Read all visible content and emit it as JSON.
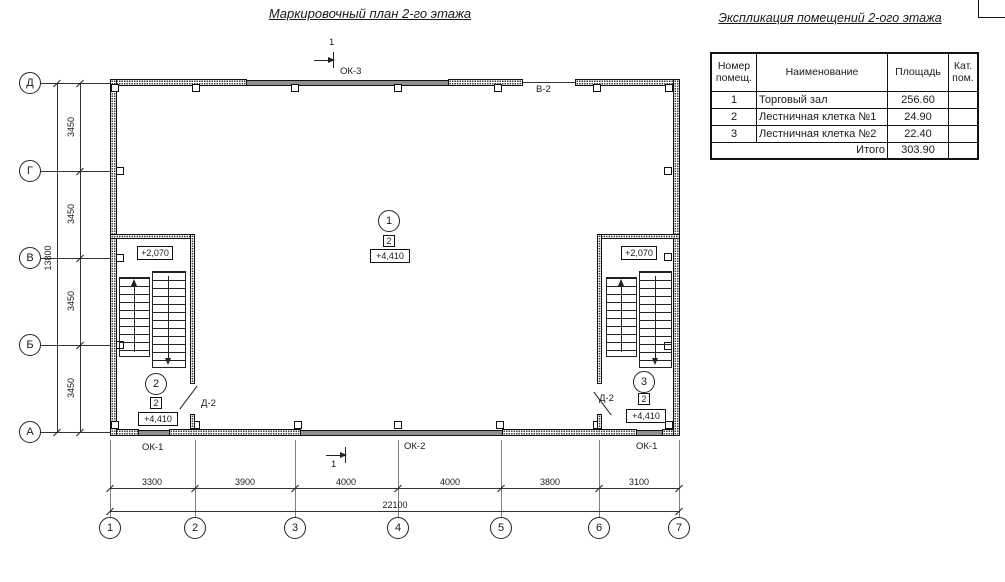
{
  "titles": {
    "plan": "Маркировочный план 2-го этажа",
    "schedule": "Экспликация помещений 2-ого этажа"
  },
  "schedule_table": {
    "headers": {
      "number": "Номер помещ.",
      "name": "Наименование",
      "area": "Площадь",
      "category": "Кат. пом."
    },
    "rows": [
      {
        "number": "1",
        "name": "Торговый зал",
        "area": "256.60",
        "category": ""
      },
      {
        "number": "2",
        "name": "Лестничная клетка №1",
        "area": "24.90",
        "category": ""
      },
      {
        "number": "3",
        "name": "Лестничная клетка №2",
        "area": "22.40",
        "category": ""
      }
    ],
    "total": {
      "label": "Итого",
      "area": "303.90"
    }
  },
  "axes": {
    "vertical": [
      "Д",
      "Г",
      "В",
      "Б",
      "А"
    ],
    "horizontal": [
      "1",
      "2",
      "3",
      "4",
      "5",
      "6",
      "7"
    ]
  },
  "dimensions": {
    "left_segments": [
      "3450",
      "3450",
      "3450",
      "3450"
    ],
    "left_total": "13800",
    "bottom_segments": [
      "3300",
      "3900",
      "4000",
      "4000",
      "3800",
      "3100"
    ],
    "bottom_total": "22100"
  },
  "plan_labels": {
    "window_top": "ОК-3",
    "opening_top": "В-2",
    "window_bottom_left": "ОК-1",
    "window_bottom_center": "ОК-2",
    "window_bottom_right": "ОК-1",
    "door_left": "Д-2",
    "door_right": "Д-2",
    "section_top": "1",
    "section_bottom": "1"
  },
  "room_markers": {
    "hall": {
      "number": "1",
      "type": "2",
      "elevation": "+4,410"
    },
    "stair1": {
      "number": "2",
      "type": "2",
      "elevation": "+4,410",
      "landing_elevation": "+2,070"
    },
    "stair2": {
      "number": "3",
      "type": "2",
      "elevation": "+4,410",
      "landing_elevation": "+2,070"
    }
  },
  "colors": {
    "line": "#1a1a1a",
    "window_fill": "#8f8f8f",
    "background": "#ffffff"
  }
}
